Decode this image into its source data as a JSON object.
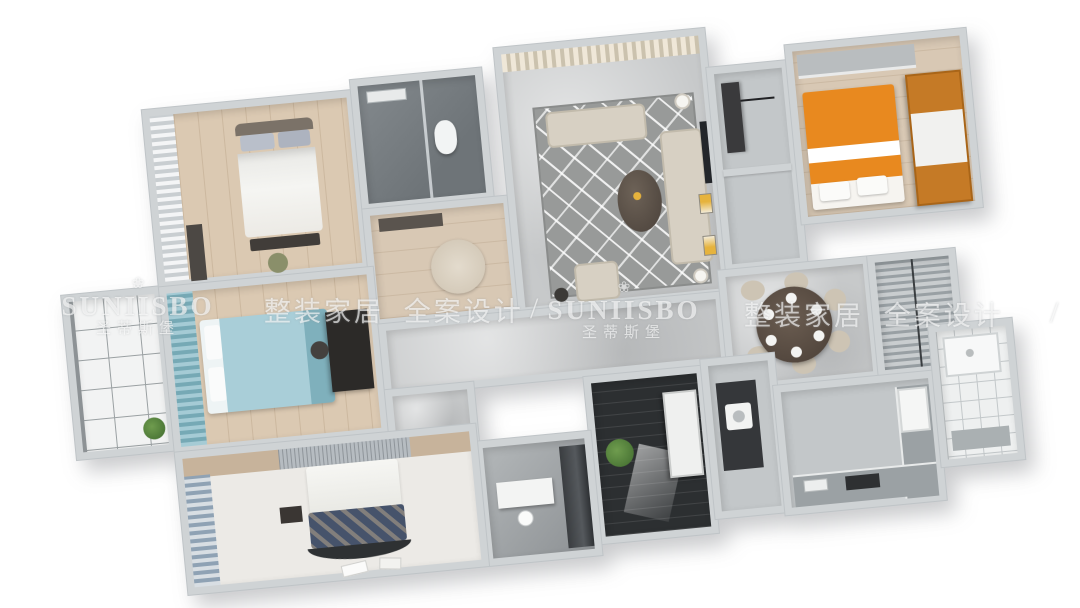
{
  "watermark": {
    "brand_latin": "SUNIISBO",
    "brand_cn": "圣蒂斯堡",
    "tagline_cn": "整装家居 全案设计",
    "separator": "/",
    "logo_icon": "lotus-crown-icon",
    "logo_glyph": "❀",
    "text_color": "#ffffff"
  },
  "scene": {
    "type": "3d-floor-plan-render",
    "view": "top-down dollhouse render, tilted about -5.5 degrees",
    "background": "#ffffff",
    "wall_color": "#cfd3d5",
    "rooms": [
      {
        "name": "balcony",
        "floor": "white-tile-grid",
        "items": [
          "potted-plant",
          "glass-door"
        ]
      },
      {
        "name": "master-bedroom",
        "floor": "light-wood",
        "items": [
          "double-bed",
          "gray-pillows",
          "foot-bench",
          "pouf",
          "dresser",
          "white-curtain-window"
        ]
      },
      {
        "name": "bathroom-1",
        "floor": "dark-gray-tile",
        "items": [
          "toilet",
          "glass-shower-screen",
          "vanity"
        ]
      },
      {
        "name": "dressing-hall",
        "floor": "light-wood",
        "items": [
          "round-rug",
          "vanity-table"
        ]
      },
      {
        "name": "living-room",
        "floor": "gray-marble",
        "items": [
          "geometric-rug",
          "loveseat",
          "three-seat-sofa",
          "armchair",
          "oval-coffee-table",
          "floor-lamp",
          "tv-panel",
          "yellow-art-frames",
          "beige-curtain-wall"
        ]
      },
      {
        "name": "entry-storage",
        "floor": "gray",
        "items": [
          "dark-console-shelf"
        ]
      },
      {
        "name": "kids-bedroom",
        "floor": "light-wood",
        "items": [
          "orange-white-bed",
          "orange-wardrobe",
          "desk"
        ]
      },
      {
        "name": "bedroom-2",
        "floor": "light-wood",
        "items": [
          "teal-bed",
          "teal-curtain-window",
          "dark-desk",
          "chair"
        ]
      },
      {
        "name": "corridor",
        "floor": "gray-marble",
        "items": []
      },
      {
        "name": "dining-room",
        "floor": "gray-marble",
        "items": [
          "round-dark-table",
          "six-plates",
          "six-beige-chairs"
        ]
      },
      {
        "name": "window-bay",
        "floor": "louver-blinds",
        "items": [
          "gray-blinds"
        ]
      },
      {
        "name": "kitchen",
        "floor": "gray",
        "items": [
          "l-shaped-counter",
          "cooktop",
          "refrigerator",
          "white-wall-tile"
        ]
      },
      {
        "name": "bathroom-2",
        "floor": "white-small-tile",
        "items": [
          "shower-tray",
          "vanity-counter"
        ]
      },
      {
        "name": "laundry-hall",
        "floor": "gray",
        "items": [
          "dark-cabinet",
          "washing-machine"
        ]
      },
      {
        "name": "utility-room",
        "floor": "dark-plank",
        "items": [
          "white-cabinet",
          "potted-plant",
          "light-patch"
        ]
      },
      {
        "name": "study",
        "floor": "gray",
        "items": [
          "white-desk",
          "white-chair",
          "dark-wardrobe"
        ]
      },
      {
        "name": "bedroom-3",
        "floor": "pale",
        "items": [
          "bed-navy-pillows",
          "white-duvet",
          "curved-foot-bench",
          "nightstand",
          "blue-curtain-window",
          "fringe-headboard-wall",
          "papers"
        ]
      }
    ],
    "palette": {
      "wood": "#dbc9b2",
      "marble": "#c7c9ca",
      "dark_tile": "#747a7e",
      "orange_accent": "#e8891f",
      "orange_wood": "#c57a26",
      "teal": "#a5cbd5",
      "navy": "#46536b",
      "dark_floor": "#2c2f31",
      "plant_green": "#4c7a38",
      "frame_yellow": "#e6b33d"
    }
  }
}
